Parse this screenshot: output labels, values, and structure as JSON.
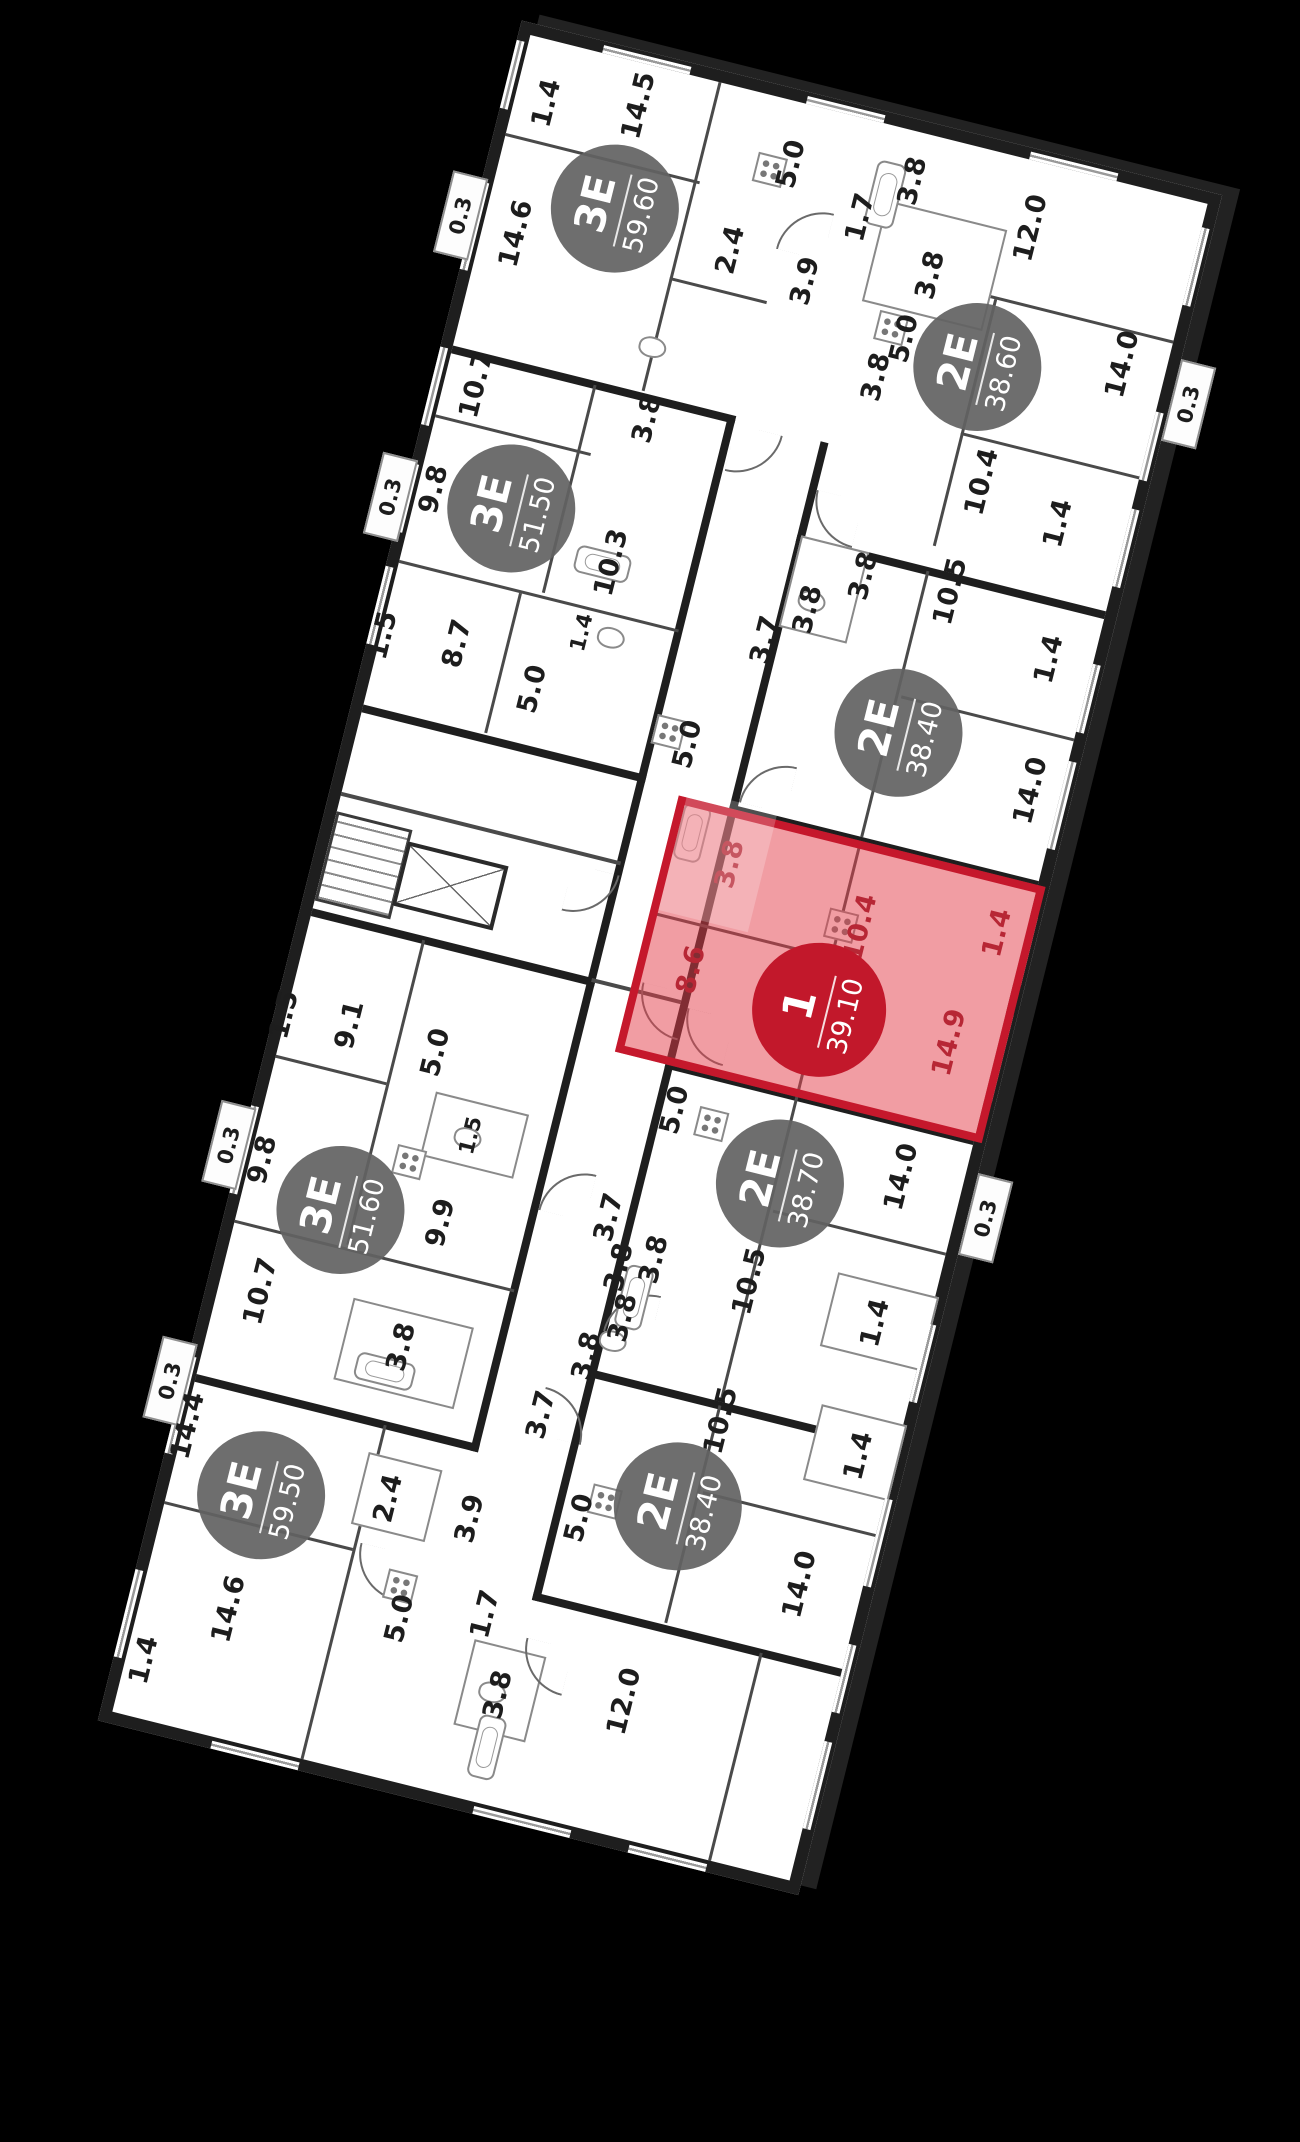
{
  "scene": {
    "background": "#000000",
    "floor_color": "#ffffff",
    "wall_color": "#1e1e1e",
    "badge_color": "#626262",
    "highlight_fill": "#e43c48",
    "highlight_border": "#c5182c",
    "highlight_badge": "#c2182b",
    "rotation_deg": -76
  },
  "units": [
    {
      "id": "3e-5960",
      "type": "3Е",
      "area": "59.60",
      "highlighted": false,
      "badge": {
        "x": 1696,
        "y": 170
      },
      "rooms": [
        {
          "label": "1.4",
          "x": 1782,
          "y": 78
        },
        {
          "label": "14.5",
          "x": 1802,
          "y": 168
        },
        {
          "label": "14.6",
          "x": 1648,
          "y": 80
        },
        {
          "label": "5.0",
          "x": 1782,
          "y": 330
        },
        {
          "label": "3.8",
          "x": 1795,
          "y": 452
        },
        {
          "label": "2.4",
          "x": 1684,
          "y": 292
        },
        {
          "label": "3.9",
          "x": 1672,
          "y": 372
        },
        {
          "label": "1.7",
          "x": 1747,
          "y": 410
        }
      ]
    },
    {
      "id": "2e-3860",
      "type": "2Е",
      "area": "38.60",
      "highlighted": false,
      "badge": {
        "x": 1630,
        "y": 560
      },
      "rooms": [
        {
          "label": "12.0",
          "x": 1778,
          "y": 578
        },
        {
          "label": "10.4",
          "x": 1520,
          "y": 592
        },
        {
          "label": "14.0",
          "x": 1668,
          "y": 700
        },
        {
          "label": "5.0",
          "x": 1640,
          "y": 482
        },
        {
          "label": "3.8",
          "x": 1708,
          "y": 492
        },
        {
          "label": "3.8",
          "x": 1596,
          "y": 464
        },
        {
          "label": "1.4",
          "x": 1498,
          "y": 676
        }
      ]
    },
    {
      "id": "3e-5150",
      "type": "3Е",
      "area": "51.50",
      "highlighted": false,
      "badge": {
        "x": 1380,
        "y": 142
      },
      "rooms": [
        {
          "label": "9.8",
          "x": 1380,
          "y": 62
        },
        {
          "label": "10.7",
          "x": 1492,
          "y": 78
        },
        {
          "label": "10.3",
          "x": 1352,
          "y": 252
        },
        {
          "label": "8.7",
          "x": 1236,
          "y": 122
        },
        {
          "label": "5.0",
          "x": 1210,
          "y": 206
        },
        {
          "label": "1.4",
          "x": 1277,
          "y": 240,
          "small": true
        },
        {
          "label": "1.5",
          "x": 1226,
          "y": 48
        },
        {
          "label": "3.8",
          "x": 1500,
          "y": 252
        }
      ]
    },
    {
      "id": "2e-3840a",
      "type": "2Е",
      "area": "38.40",
      "highlighted": false,
      "badge": {
        "x": 1256,
        "y": 572
      },
      "rooms": [
        {
          "label": "10.5",
          "x": 1406,
          "y": 588
        },
        {
          "label": "14.0",
          "x": 1232,
          "y": 714
        },
        {
          "label": "5.0",
          "x": 1194,
          "y": 370
        },
        {
          "label": "3.7",
          "x": 1314,
          "y": 420
        },
        {
          "label": "3.8",
          "x": 1354,
          "y": 454
        },
        {
          "label": "3.8",
          "x": 1400,
          "y": 500
        },
        {
          "label": "1.4",
          "x": 1364,
          "y": 700
        }
      ]
    },
    {
      "id": "1-3910",
      "type": "1",
      "area": "39.10",
      "highlighted": true,
      "badge": {
        "x": 968,
        "y": 562
      },
      "rooms": [
        {
          "label": "8.6",
          "x": 976,
          "y": 428
        },
        {
          "label": "10.4",
          "x": 1058,
          "y": 582
        },
        {
          "label": "3.8",
          "x": 1088,
          "y": 440
        },
        {
          "label": "14.9",
          "x": 968,
          "y": 696
        },
        {
          "label": "1.4",
          "x": 1086,
          "y": 716
        }
      ]
    },
    {
      "id": "2e-3870",
      "type": "2Е",
      "area": "38.70",
      "highlighted": false,
      "badge": {
        "x": 790,
        "y": 566
      },
      "rooms": [
        {
          "label": "5.0",
          "x": 836,
          "y": 446
        },
        {
          "label": "3.7",
          "x": 716,
          "y": 408
        },
        {
          "label": "10.5",
          "x": 688,
          "y": 560
        },
        {
          "label": "14.0",
          "x": 826,
          "y": 682
        },
        {
          "label": "1.4",
          "x": 678,
          "y": 692
        },
        {
          "label": "3.8",
          "x": 670,
          "y": 430
        },
        {
          "label": "3.8",
          "x": 686,
          "y": 462
        }
      ]
    },
    {
      "id": "3e-5160",
      "type": "3Е",
      "area": "51.60",
      "highlighted": false,
      "badge": {
        "x": 658,
        "y": 146
      },
      "rooms": [
        {
          "label": "9.8",
          "x": 688,
          "y": 58
        },
        {
          "label": "1.5",
          "x": 834,
          "y": 44
        },
        {
          "label": "9.1",
          "x": 840,
          "y": 110
        },
        {
          "label": "5.0",
          "x": 834,
          "y": 200
        },
        {
          "label": "1.5",
          "x": 762,
          "y": 254,
          "small": true
        },
        {
          "label": "9.9",
          "x": 670,
          "y": 246
        },
        {
          "label": "10.7",
          "x": 560,
          "y": 88
        },
        {
          "label": "3.8",
          "x": 540,
          "y": 238
        }
      ]
    },
    {
      "id": "3e-5950",
      "type": "3Е",
      "area": "59.50",
      "highlighted": false,
      "badge": {
        "x": 362,
        "y": 138
      },
      "rooms": [
        {
          "label": "14.4",
          "x": 412,
          "y": 50
        },
        {
          "label": "14.6",
          "x": 244,
          "y": 134
        },
        {
          "label": "1.4",
          "x": 174,
          "y": 64
        },
        {
          "label": "2.4",
          "x": 390,
          "y": 262
        },
        {
          "label": "3.9",
          "x": 390,
          "y": 346
        },
        {
          "label": "5.0",
          "x": 276,
          "y": 302
        },
        {
          "label": "1.7",
          "x": 301,
          "y": 384
        },
        {
          "label": "3.8",
          "x": 226,
          "y": 416
        },
        {
          "label": "12.0",
          "x": 250,
          "y": 540
        }
      ]
    },
    {
      "id": "2e-3840b",
      "type": "2Е",
      "area": "38.40",
      "highlighted": false,
      "badge": {
        "x": 452,
        "y": 545
      },
      "rooms": [
        {
          "label": "10.5",
          "x": 546,
          "y": 566
        },
        {
          "label": "14.0",
          "x": 406,
          "y": 682
        },
        {
          "label": "5.0",
          "x": 417,
          "y": 452
        },
        {
          "label": "3.7",
          "x": 508,
          "y": 390
        },
        {
          "label": "3.8",
          "x": 576,
          "y": 420
        },
        {
          "label": "3.8",
          "x": 622,
          "y": 446
        },
        {
          "label": "1.4",
          "x": 545,
          "y": 708
        }
      ]
    }
  ],
  "balconies": [
    {
      "label": "0.3",
      "x": 1652,
      "y": 22,
      "side": "back"
    },
    {
      "label": "0.3",
      "x": 1362,
      "y": 22,
      "side": "back"
    },
    {
      "label": "0.3",
      "x": 694,
      "y": 22,
      "side": "back"
    },
    {
      "label": "0.3",
      "x": 451,
      "y": 22,
      "side": "back"
    },
    {
      "label": "0.3",
      "x": 806,
      "y": 774,
      "side": "front"
    },
    {
      "label": "0.3",
      "x": 1645,
      "y": 774,
      "side": "front"
    }
  ]
}
